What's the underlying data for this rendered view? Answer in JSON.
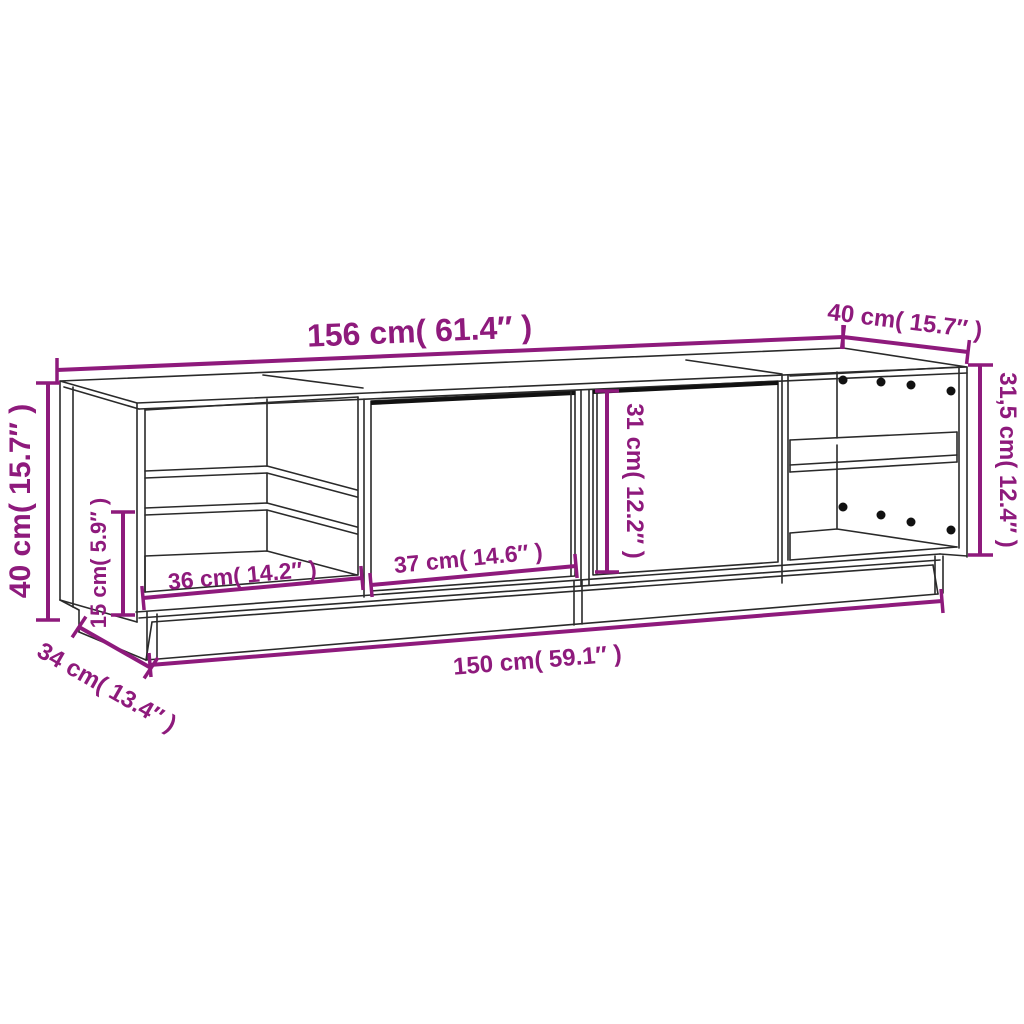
{
  "diagram": {
    "title": "TV cabinet dimension diagram",
    "background": "#ffffff",
    "accent_color": "#8e1a7c",
    "line_color": "#2a2a2a",
    "labels": {
      "overall_width": "156 cm( 61.4″ )",
      "top_depth": "40 cm( 15.7″ )",
      "side_height_right": "31,5 cm( 12.4″ )",
      "overall_height": "40 cm( 15.7″ )",
      "shelf_spacing": "15 cm( 5.9″ )",
      "left_compartment_width": "36 cm( 14.2″ )",
      "door_width": "37 cm( 14.6″ )",
      "door_height": "31 cm( 12.2″ )",
      "base_width": "150 cm( 59.1″ )",
      "base_depth": "34 cm( 13.4″ )"
    }
  }
}
